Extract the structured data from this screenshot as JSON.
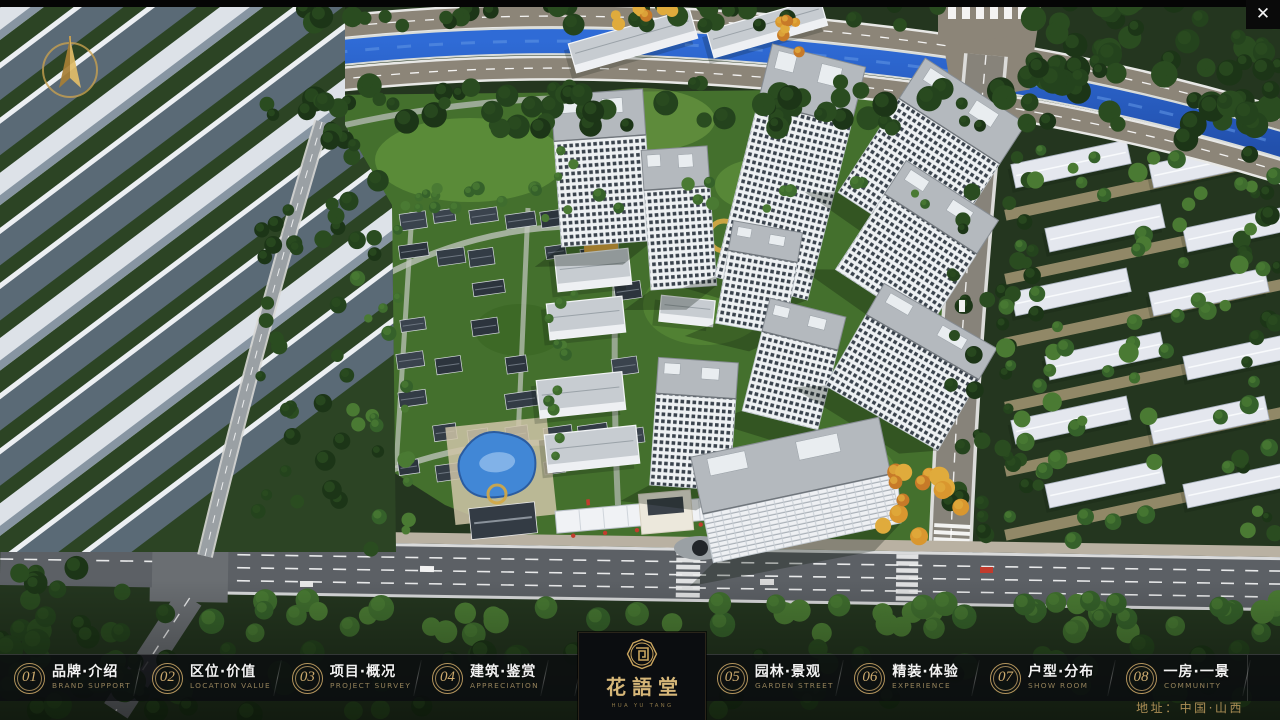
{
  "window": {
    "close_glyph": "✕"
  },
  "nav": {
    "items": [
      {
        "num": "01",
        "zh": "品牌·介绍",
        "en": "BRAND SUPPORT"
      },
      {
        "num": "02",
        "zh": "区位·价值",
        "en": "LOCATION VALUE"
      },
      {
        "num": "03",
        "zh": "项目·概况",
        "en": "PROJECT SURVEY"
      },
      {
        "num": "04",
        "zh": "建筑·鉴赏",
        "en": "APPRECIATION"
      },
      {
        "num": "05",
        "zh": "园林·景观",
        "en": "GARDEN STREET"
      },
      {
        "num": "06",
        "zh": "精装·体验",
        "en": "EXPERIENCE"
      },
      {
        "num": "07",
        "zh": "户型·分布",
        "en": "SHOW ROOM"
      },
      {
        "num": "08",
        "zh": "一房·一景",
        "en": "COMMUNITY"
      }
    ]
  },
  "logo": {
    "title": "花語堂",
    "subtitle": "HUA YU TANG"
  },
  "footer": {
    "address": "地址：中国·山西"
  },
  "colors": {
    "accent_gold": "#C9A76B",
    "bar_bg": "rgba(10,12,15,0.78)",
    "river_blue": "#2A62C8",
    "label_white": "#F2F2F2",
    "en_gold": "#93815A",
    "address_gold": "#AB8E55"
  }
}
